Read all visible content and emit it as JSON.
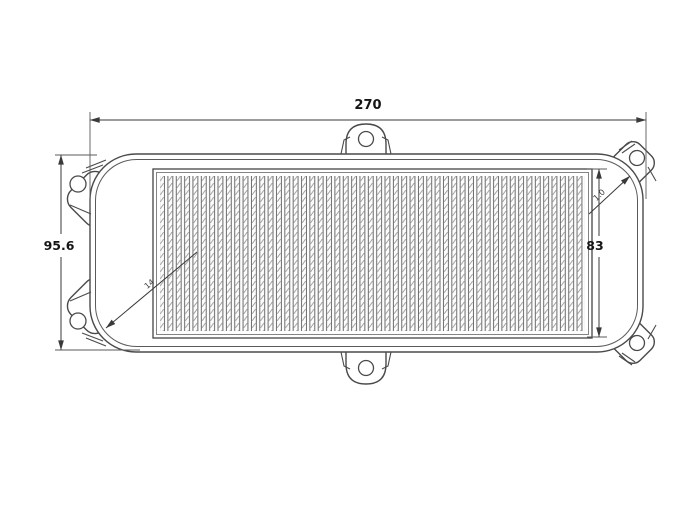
{
  "drawing": {
    "type": "technical-drawing",
    "dimensions": {
      "overall_width": "270",
      "overall_height": "95.6",
      "media_height": "83",
      "left_leader": "14",
      "right_leader": "1.0"
    },
    "colors": {
      "background": "#ffffff",
      "line": "#4a4a4a",
      "dimension_text": "#151515"
    }
  }
}
